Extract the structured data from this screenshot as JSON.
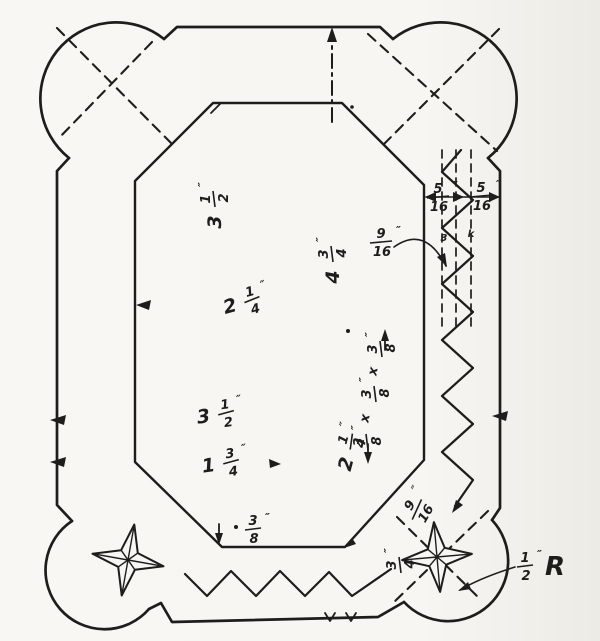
{
  "figure": {
    "paper_color": "#f7f6f2",
    "ink_color": "#1e1d1b",
    "labels": [
      {
        "id": "width-upper",
        "whole": "3",
        "num": "1",
        "den": "2",
        "unit": "″"
      },
      {
        "id": "height-mid",
        "whole": "4",
        "num": "3",
        "den": "4",
        "unit": "″"
      },
      {
        "id": "width-center",
        "whole": "2",
        "num": "1",
        "den": "4",
        "unit": "″"
      },
      {
        "id": "width-lower",
        "whole": "3",
        "num": "1",
        "den": "2",
        "unit": "″"
      },
      {
        "id": "width-lower-2",
        "whole": "1",
        "num": "3",
        "den": "4",
        "unit": "″"
      },
      {
        "id": "notch-bottom",
        "num": "3",
        "den": "8",
        "unit": "″"
      },
      {
        "id": "notch-col-1",
        "num": "3",
        "den": "8",
        "unit": "″"
      },
      {
        "id": "notch-col-x1",
        "text": "x"
      },
      {
        "id": "notch-col-2",
        "num": "3",
        "den": "8",
        "unit": "″"
      },
      {
        "id": "notch-col-x2",
        "text": "x"
      },
      {
        "id": "notch-col-3",
        "num": "3",
        "den": "8",
        "unit": "″"
      },
      {
        "id": "height-lower",
        "whole": "2",
        "num": "1",
        "den": "4",
        "unit": "″"
      },
      {
        "id": "band-left",
        "num": "5",
        "den": "16",
        "unit": "″"
      },
      {
        "id": "band-right",
        "num": "5",
        "den": "16",
        "unit": "″"
      },
      {
        "id": "band-depth",
        "num": "9",
        "den": "16",
        "unit": "″"
      },
      {
        "id": "corner-offset",
        "num": "9",
        "den": "16",
        "unit": "″"
      },
      {
        "id": "zigzag-tooth",
        "num": "3",
        "den": "4",
        "unit": "″"
      },
      {
        "id": "corner-radius",
        "num": "1",
        "den": "2",
        "unit": "″",
        "suffix": "R"
      },
      {
        "id": "stray-3",
        "text": "3"
      },
      {
        "id": "stray-k",
        "text": "k"
      }
    ]
  }
}
